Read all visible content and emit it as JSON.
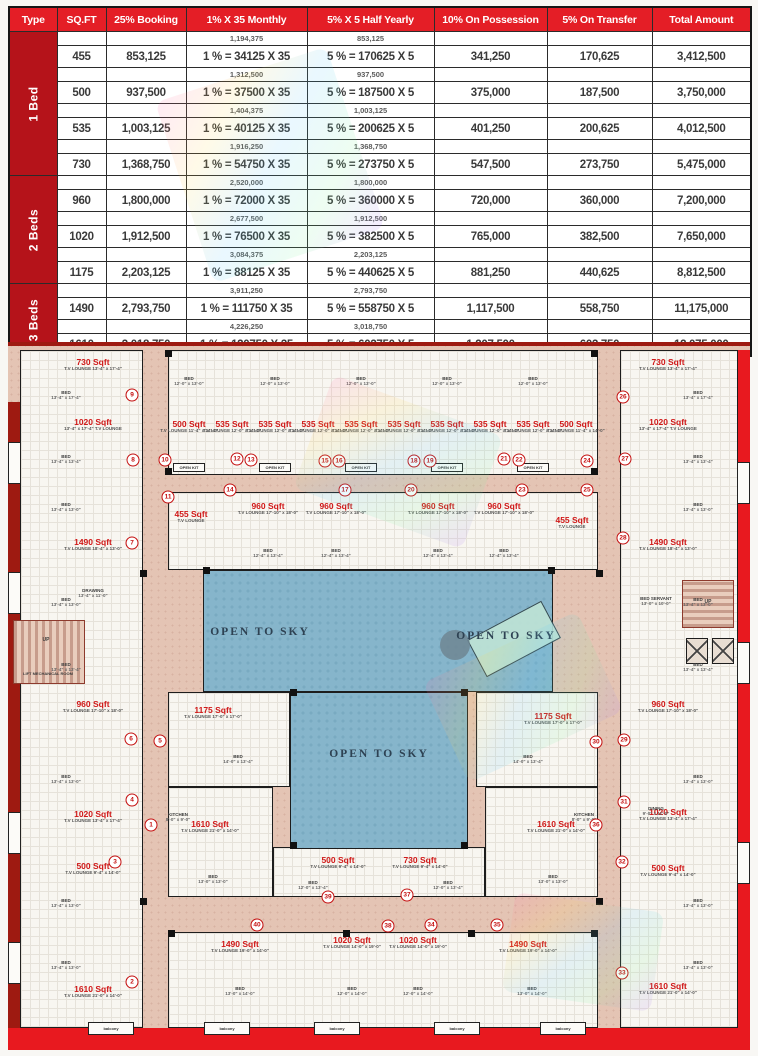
{
  "payment_table": {
    "headers": [
      "Type",
      "SQ.FT",
      "25% Booking",
      "1% X 35 Monthly",
      "5% X 5 Half Yearly",
      "10% On Possession",
      "5% On Transfer",
      "Total Amount"
    ],
    "col_widths": [
      48,
      49,
      80,
      121,
      127,
      113,
      105,
      99
    ],
    "groups": [
      {
        "type": "1 Bed",
        "rows": [
          {
            "sqft": "455",
            "booking": "853,125",
            "monthly_total": "1,194,375",
            "monthly": "1 % = 34125 X 35",
            "half_total": "853,125",
            "half": "5 % = 170625 X 5",
            "possession": "341,250",
            "transfer": "170,625",
            "total": "3,412,500"
          },
          {
            "sqft": "500",
            "booking": "937,500",
            "monthly_total": "1,312,500",
            "monthly": "1 % = 37500 X 35",
            "half_total": "937,500",
            "half": "5 % = 187500 X 5",
            "possession": "375,000",
            "transfer": "187,500",
            "total": "3,750,000"
          },
          {
            "sqft": "535",
            "booking": "1,003,125",
            "monthly_total": "1,404,375",
            "monthly": "1 % = 40125 X 35",
            "half_total": "1,003,125",
            "half": "5 % = 200625 X 5",
            "possession": "401,250",
            "transfer": "200,625",
            "total": "4,012,500"
          },
          {
            "sqft": "730",
            "booking": "1,368,750",
            "monthly_total": "1,916,250",
            "monthly": "1 % = 54750 X 35",
            "half_total": "1,368,750",
            "half": "5 % = 273750 X 5",
            "possession": "547,500",
            "transfer": "273,750",
            "total": "5,475,000"
          }
        ]
      },
      {
        "type": "2 Beds",
        "rows": [
          {
            "sqft": "960",
            "booking": "1,800,000",
            "monthly_total": "2,520,000",
            "monthly": "1 % = 72000 X 35",
            "half_total": "1,800,000",
            "half": "5 % = 360000 X 5",
            "possession": "720,000",
            "transfer": "360,000",
            "total": "7,200,000"
          },
          {
            "sqft": "1020",
            "booking": "1,912,500",
            "monthly_total": "2,677,500",
            "monthly": "1 % = 76500 X 35",
            "half_total": "1,912,500",
            "half": "5 % = 382500 X 5",
            "possession": "765,000",
            "transfer": "382,500",
            "total": "7,650,000"
          },
          {
            "sqft": "1175",
            "booking": "2,203,125",
            "monthly_total": "3,084,375",
            "monthly": "1 % = 88125 X 35",
            "half_total": "2,203,125",
            "half": "5 % = 440625 X 5",
            "possession": "881,250",
            "transfer": "440,625",
            "total": "8,812,500"
          }
        ]
      },
      {
        "type": "3 Beds",
        "rows": [
          {
            "sqft": "1490",
            "booking": "2,793,750",
            "monthly_total": "3,911,250",
            "monthly": "1 % = 111750 X 35",
            "half_total": "2,793,750",
            "half": "5 % = 558750 X 5",
            "possession": "1,117,500",
            "transfer": "558,750",
            "total": "11,175,000"
          },
          {
            "sqft": "1610",
            "booking": "3,018,750",
            "monthly_total": "4,226,250",
            "monthly": "1 % = 120750 X 35",
            "half_total": "3,018,750",
            "half": "5 % = 603750 X 5",
            "possession": "1,207,500",
            "transfer": "603,750",
            "total": "12,075,000"
          }
        ]
      }
    ],
    "colors": {
      "header_red": "#e41e26",
      "type_red": "#b5131a"
    }
  },
  "floor_plan": {
    "colors": {
      "corridor_pink": "#e4c4b4",
      "courtyard_blue": "#86b5cb",
      "band_red": "#e8191f",
      "maroon": "#9e1a11",
      "unit_red": "#d01818"
    },
    "blocks": [
      [
        12,
        8,
        123,
        678
      ],
      [
        612,
        8,
        118,
        678
      ],
      [
        160,
        8,
        430,
        125
      ],
      [
        160,
        150,
        430,
        78
      ],
      [
        160,
        350,
        122,
        95
      ],
      [
        468,
        350,
        122,
        95
      ],
      [
        160,
        445,
        105,
        110
      ],
      [
        477,
        445,
        113,
        110
      ],
      [
        265,
        505,
        212,
        50
      ],
      [
        160,
        590,
        430,
        96
      ]
    ],
    "courtyards": [
      [
        195,
        228,
        350,
        122
      ],
      [
        282,
        350,
        178,
        157
      ]
    ],
    "open_to_sky_label": "OPEN TO SKY",
    "open_to_sky_positions": [
      [
        252,
        290
      ],
      [
        498,
        294
      ],
      [
        371,
        412
      ]
    ],
    "units": [
      {
        "a": "730 Sqft",
        "s": "T.V LOUNGE 13'-4\" x 17'-4\"",
        "x": 85,
        "y": 16
      },
      {
        "a": "1020 Sqft",
        "s": "13'-4\" x 17'-4\" T.V LOUNGE",
        "x": 85,
        "y": 76
      },
      {
        "a": "1490 Sqft",
        "s": "T.V LOUNGE 18'-4\" x 13'-0\"",
        "x": 85,
        "y": 196
      },
      {
        "a": "960 Sqft",
        "s": "T.V LOUNGE 17'-10\" x 18'-0\"",
        "x": 85,
        "y": 358
      },
      {
        "a": "1020 Sqft",
        "s": "T.V LOUNGE 13'-4\" x 17'-4\"",
        "x": 85,
        "y": 468
      },
      {
        "a": "500 Sqft",
        "s": "T.V LOUNGE 9'-4\" x 14'-0\"",
        "x": 85,
        "y": 520
      },
      {
        "a": "1610 Sqft",
        "s": "T.V LOUNGE 21'-0\" x 14'-0\"",
        "x": 85,
        "y": 643
      },
      {
        "a": "730 Sqft",
        "s": "T.V LOUNGE 13'-4\" x 17'-4\"",
        "x": 660,
        "y": 16
      },
      {
        "a": "1020 Sqft",
        "s": "13'-4\" x 17'-4\" T.V LOUNGE",
        "x": 660,
        "y": 76
      },
      {
        "a": "1490 Sqft",
        "s": "T.V LOUNGE 18'-4\" x 13'-0\"",
        "x": 660,
        "y": 196
      },
      {
        "a": "960 Sqft",
        "s": "T.V LOUNGE 17'-10\" x 18'-0\"",
        "x": 660,
        "y": 358
      },
      {
        "a": "1020 Sqft",
        "s": "T.V LOUNGE 13'-4\" x 17'-4\"",
        "x": 660,
        "y": 466
      },
      {
        "a": "500 Sqft",
        "s": "T.V LOUNGE 9'-4\" x 14'-0\"",
        "x": 660,
        "y": 522
      },
      {
        "a": "1610 Sqft",
        "s": "T.V LOUNGE 21'-0\" x 14'-0\"",
        "x": 660,
        "y": 640
      },
      {
        "a": "1175 Sqft",
        "s": "T.V LOUNGE 17'-0\" x 17'-0\"",
        "x": 205,
        "y": 364
      },
      {
        "a": "1175 Sqft",
        "s": "T.V LOUNGE 17'-0\" x 17'-0\"",
        "x": 545,
        "y": 370
      },
      {
        "a": "500 Sqft",
        "s": "T.V LOUNGE 11'-4\" x 14'-0\"",
        "x": 181,
        "y": 78
      },
      {
        "a": "535 Sqft",
        "s": "T.V LOUNGE 12'-0\" x 14'-0\"",
        "x": 224,
        "y": 78
      },
      {
        "a": "535 Sqft",
        "s": "T.V LOUNGE 12'-0\" x 14'-0\"",
        "x": 267,
        "y": 78
      },
      {
        "a": "535 Sqft",
        "s": "T.V LOUNGE 12'-0\" x 14'-0\"",
        "x": 310,
        "y": 78
      },
      {
        "a": "535 Sqft",
        "s": "T.V LOUNGE 12'-0\" x 14'-0\"",
        "x": 353,
        "y": 78
      },
      {
        "a": "535 Sqft",
        "s": "T.V LOUNGE 12'-0\" x 14'-0\"",
        "x": 396,
        "y": 78
      },
      {
        "a": "535 Sqft",
        "s": "T.V LOUNGE 12'-0\" x 14'-0\"",
        "x": 439,
        "y": 78
      },
      {
        "a": "535 Sqft",
        "s": "T.V LOUNGE 12'-0\" x 14'-0\"",
        "x": 482,
        "y": 78
      },
      {
        "a": "535 Sqft",
        "s": "T.V LOUNGE 12'-0\" x 14'-0\"",
        "x": 525,
        "y": 78
      },
      {
        "a": "500 Sqft",
        "s": "T.V LOUNGE 11'-4\" x 14'-0\"",
        "x": 568,
        "y": 78
      },
      {
        "a": "455 Sqft",
        "s": "T.V LOUNGE",
        "x": 183,
        "y": 168
      },
      {
        "a": "960 Sqft",
        "s": "T.V LOUNGE 17'-10\" x 18'-0\"",
        "x": 260,
        "y": 160
      },
      {
        "a": "960 Sqft",
        "s": "T.V LOUNGE 17'-10\" x 18'-0\"",
        "x": 328,
        "y": 160
      },
      {
        "a": "960 Sqft",
        "s": "T.V LOUNGE 17'-10\" x 18'-0\"",
        "x": 430,
        "y": 160
      },
      {
        "a": "960 Sqft",
        "s": "T.V LOUNGE 17'-10\" x 18'-0\"",
        "x": 496,
        "y": 160
      },
      {
        "a": "455 Sqft",
        "s": "T.V LOUNGE",
        "x": 564,
        "y": 174
      },
      {
        "a": "1610 Sqft",
        "s": "T.V LOUNGE 21'-0\" x 14'-0\"",
        "x": 202,
        "y": 478
      },
      {
        "a": "1610 Sqft",
        "s": "T.V LOUNGE 21'-0\" x 14'-0\"",
        "x": 548,
        "y": 478
      },
      {
        "a": "500 Sqft",
        "s": "T.V LOUNGE 9'-4\" x 14'-0\"",
        "x": 330,
        "y": 514
      },
      {
        "a": "730 Sqft",
        "s": "T.V LOUNGE 9'-4\" x 14'-0\"",
        "x": 412,
        "y": 514
      },
      {
        "a": "1490 Sqft",
        "s": "T.V LOUNGE 19'-0\" x 14'-0\"",
        "x": 232,
        "y": 598
      },
      {
        "a": "1020 Sqft",
        "s": "T.V LOUNGE 14'-0\" x 19'-0\"",
        "x": 344,
        "y": 594
      },
      {
        "a": "1020 Sqft",
        "s": "T.V LOUNGE 14'-0\" x 19'-0\"",
        "x": 410,
        "y": 594
      },
      {
        "a": "1490 Sqft",
        "s": "T.V LOUNGE 19'-0\" x 14'-0\"",
        "x": 520,
        "y": 598
      }
    ],
    "markers": [
      [
        "9",
        124,
        53
      ],
      [
        "8",
        125,
        118
      ],
      [
        "7",
        124,
        201
      ],
      [
        "6",
        123,
        397
      ],
      [
        "5",
        152,
        399
      ],
      [
        "4",
        124,
        458
      ],
      [
        "3",
        107,
        520
      ],
      [
        "2",
        124,
        640
      ],
      [
        "1",
        143,
        483
      ],
      [
        "26",
        615,
        55
      ],
      [
        "27",
        617,
        117
      ],
      [
        "28",
        615,
        196
      ],
      [
        "29",
        616,
        398
      ],
      [
        "30",
        588,
        400
      ],
      [
        "31",
        616,
        460
      ],
      [
        "32",
        614,
        520
      ],
      [
        "33",
        614,
        631
      ],
      [
        "10",
        157,
        118
      ],
      [
        "12",
        229,
        117
      ],
      [
        "13",
        243,
        118
      ],
      [
        "15",
        317,
        119
      ],
      [
        "16",
        331,
        119
      ],
      [
        "18",
        406,
        119
      ],
      [
        "19",
        422,
        119
      ],
      [
        "21",
        496,
        117
      ],
      [
        "22",
        511,
        118
      ],
      [
        "24",
        579,
        119
      ],
      [
        "11",
        160,
        155
      ],
      [
        "14",
        222,
        148
      ],
      [
        "17",
        337,
        148
      ],
      [
        "20",
        403,
        148
      ],
      [
        "23",
        514,
        148
      ],
      [
        "25",
        579,
        148
      ],
      [
        "36",
        588,
        483
      ],
      [
        "39",
        320,
        555
      ],
      [
        "37",
        399,
        553
      ],
      [
        "40",
        249,
        583
      ],
      [
        "38",
        380,
        584
      ],
      [
        "34",
        423,
        583
      ],
      [
        "35",
        489,
        583
      ]
    ],
    "rooms": [
      [
        "BED",
        "13'-4\" x 17'-4\"",
        58,
        48
      ],
      [
        "BED",
        "13'-4\" x 13'-4\"",
        58,
        112
      ],
      [
        "BED",
        "13'-4\" x 13'-0\"",
        58,
        160
      ],
      [
        "BED",
        "13'-4\" x 13'-0\"",
        58,
        255
      ],
      [
        "BED",
        "13'-4\" x 13'-4\"",
        58,
        320
      ],
      [
        "BED",
        "13'-4\" x 13'-0\"",
        58,
        432
      ],
      [
        "BED",
        "13'-4\" x 13'-0\"",
        58,
        556
      ],
      [
        "BED",
        "13'-4\" x 13'-0\"",
        58,
        618
      ],
      [
        "BED",
        "13'-4\" x 17'-4\"",
        690,
        48
      ],
      [
        "BED",
        "13'-4\" x 13'-4\"",
        690,
        112
      ],
      [
        "BED",
        "13'-4\" x 13'-0\"",
        690,
        160
      ],
      [
        "BED",
        "13'-4\" x 13'-0\"",
        690,
        255
      ],
      [
        "BED",
        "13'-4\" x 13'-4\"",
        690,
        320
      ],
      [
        "BED",
        "13'-4\" x 13'-0\"",
        690,
        432
      ],
      [
        "BED",
        "13'-4\" x 13'-0\"",
        690,
        556
      ],
      [
        "BED",
        "13'-4\" x 13'-0\"",
        690,
        618
      ],
      [
        "BED",
        "12'-0\" x 13'-0\"",
        181,
        34
      ],
      [
        "BED",
        "12'-0\" x 13'-0\"",
        267,
        34
      ],
      [
        "BED",
        "12'-0\" x 13'-0\"",
        353,
        34
      ],
      [
        "BED",
        "12'-0\" x 13'-0\"",
        439,
        34
      ],
      [
        "BED",
        "12'-0\" x 13'-0\"",
        525,
        34
      ],
      [
        "BED",
        "12'-4\" x 13'-4\"",
        260,
        206
      ],
      [
        "BED",
        "12'-4\" x 13'-4\"",
        328,
        206
      ],
      [
        "BED",
        "12'-4\" x 13'-4\"",
        430,
        206
      ],
      [
        "BED",
        "12'-4\" x 13'-4\"",
        496,
        206
      ],
      [
        "BED",
        "14'-0\" x 13'-4\"",
        230,
        412
      ],
      [
        "BED",
        "14'-0\" x 13'-4\"",
        520,
        412
      ],
      [
        "BED",
        "13'-0\" x 13'-0\"",
        205,
        532
      ],
      [
        "BED",
        "13'-0\" x 13'-0\"",
        545,
        532
      ],
      [
        "BED",
        "12'-0\" x 13'-4\"",
        305,
        538
      ],
      [
        "BED",
        "12'-0\" x 13'-4\"",
        440,
        538
      ],
      [
        "BED",
        "13'-0\" x 14'-0\"",
        232,
        644
      ],
      [
        "BED",
        "12'-0\" x 14'-0\"",
        344,
        644
      ],
      [
        "BED",
        "12'-0\" x 14'-0\"",
        410,
        644
      ],
      [
        "BED",
        "13'-0\" x 14'-0\"",
        524,
        644
      ],
      [
        "KITCHEN",
        "8'-0\" x 9'-0\"",
        170,
        470
      ],
      [
        "KITCHEN",
        "8'-0\" x 9'-0\"",
        576,
        470
      ],
      [
        "DRAWING",
        "13'-4\" x 11'-0\"",
        85,
        246
      ],
      [
        "DINING",
        "9'-0\" x 11'-0\"",
        648,
        464
      ],
      [
        "BED SERVANT",
        "13'-0\" x 10'-0\"",
        648,
        254
      ]
    ],
    "labels": {
      "up": "UP",
      "lift_mech": "LIFT MECHANICAL ROOM",
      "lift": "LIFT",
      "open_kit": "OPEN KIT",
      "balcony": "balcony"
    },
    "open_kit_positions": [
      [
        181,
        121
      ],
      [
        267,
        121
      ],
      [
        353,
        121
      ],
      [
        439,
        121
      ],
      [
        525,
        121
      ]
    ],
    "balconies_bottom": [
      [
        80,
        680
      ],
      [
        196,
        680
      ],
      [
        306,
        680
      ],
      [
        426,
        680
      ],
      [
        532,
        680
      ]
    ],
    "balconies_left": [
      [
        0,
        100
      ],
      [
        0,
        230
      ],
      [
        0,
        470
      ],
      [
        0,
        600
      ]
    ],
    "balconies_right": [
      [
        729,
        120
      ],
      [
        729,
        300
      ],
      [
        729,
        500
      ]
    ],
    "columns": [
      [
        157,
        8
      ],
      [
        583,
        8
      ],
      [
        157,
        126
      ],
      [
        583,
        126
      ],
      [
        195,
        225
      ],
      [
        540,
        225
      ],
      [
        282,
        347
      ],
      [
        453,
        347
      ],
      [
        282,
        500
      ],
      [
        453,
        500
      ],
      [
        132,
        228
      ],
      [
        588,
        228
      ],
      [
        132,
        556
      ],
      [
        588,
        556
      ],
      [
        160,
        588
      ],
      [
        583,
        588
      ],
      [
        335,
        588
      ],
      [
        460,
        588
      ]
    ]
  }
}
